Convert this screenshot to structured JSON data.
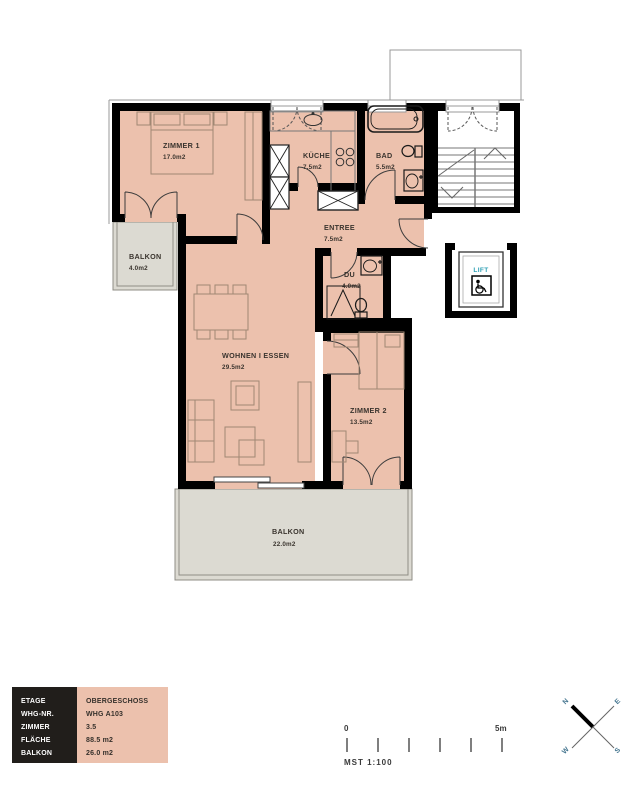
{
  "plan": {
    "rooms": {
      "zimmer1": {
        "name": "ZIMMER 1",
        "area": "17.0m2"
      },
      "kueche": {
        "name": "KÜCHE",
        "area": "7.5m2"
      },
      "bad": {
        "name": "BAD",
        "area": "5.5m2"
      },
      "entree": {
        "name": "ENTREE",
        "area": "7.5m2"
      },
      "du": {
        "name": "DU",
        "area": "4.0m2"
      },
      "wohnen": {
        "name": "WOHNEN I ESSEN",
        "area": "29.5m2"
      },
      "zimmer2": {
        "name": "ZIMMER 2",
        "area": "13.5m2"
      },
      "balkon_klein": {
        "name": "BALKON",
        "area": "4.0m2"
      },
      "balkon_gross": {
        "name": "BALKON",
        "area": "22.0m2"
      }
    },
    "lift_label": "LIFT"
  },
  "legend": {
    "rows": [
      {
        "label": "ETAGE",
        "value": "OBERGESCHOSS"
      },
      {
        "label": "WHG-NR.",
        "value": "WHG A103"
      },
      {
        "label": "ZIMMER",
        "value": "3.5"
      },
      {
        "label": "FLÄCHE",
        "value": "88.5 m2"
      },
      {
        "label": "BALKON",
        "value": "26.0 m2"
      }
    ]
  },
  "scalebar": {
    "start": "0",
    "end": "5m",
    "caption": "MST 1:100"
  },
  "compass": {
    "n": "N",
    "e": "E",
    "s": "S",
    "w": "W"
  },
  "colors": {
    "room_fill": "#ecc1ad",
    "balcony_fill": "#dcdad2",
    "wall": "#000000",
    "lift_text": "#2d9fb4"
  }
}
